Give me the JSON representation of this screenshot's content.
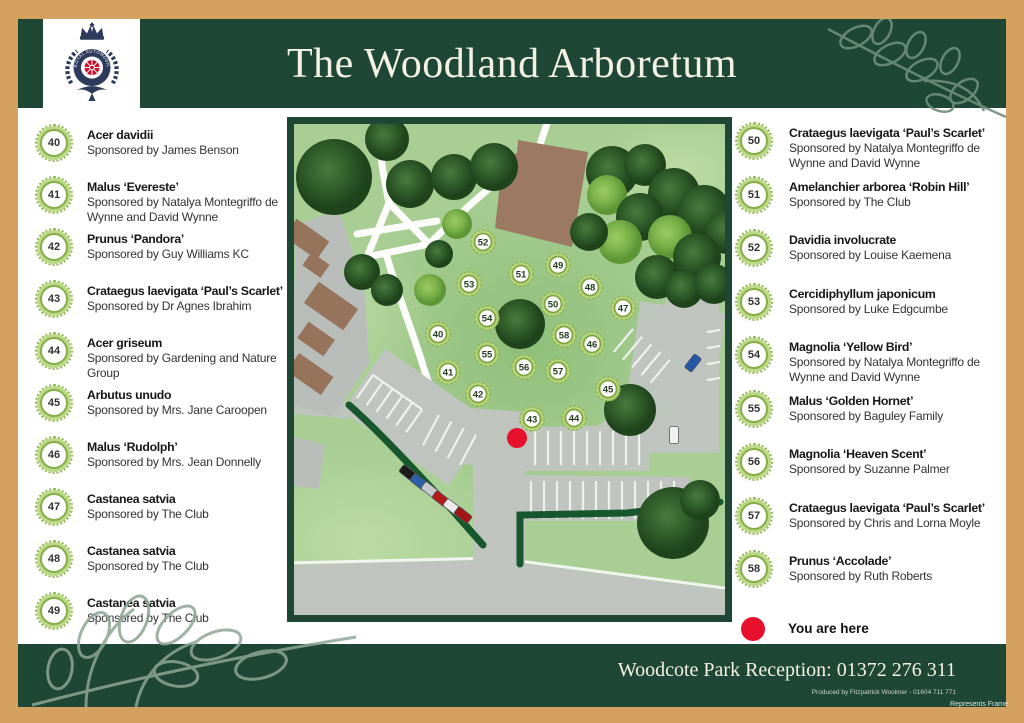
{
  "colors": {
    "frame_tan": "#D5A161",
    "band_green": "#1E4736",
    "marker_green": "#86AD48",
    "you_are_here_red": "#E8112D"
  },
  "header": {
    "title": "The Woodland Arboretum",
    "logo_text": "ROYAL AUTOMOBILE CLUB"
  },
  "left_list": [
    {
      "num": "40",
      "name": "Acer davidii",
      "sponsor": "Sponsored by James Benson"
    },
    {
      "num": "41",
      "name": "Malus ‘Evereste’",
      "sponsor": "Sponsored by Natalya Montegriffo de Wynne and David Wynne"
    },
    {
      "num": "42",
      "name": "Prunus ‘Pandora’",
      "sponsor": "Sponsored by Guy Williams KC"
    },
    {
      "num": "43",
      "name": "Crataegus laevigata ‘Paul’s Scarlet’",
      "sponsor": "Sponsored by Dr Agnes Ibrahim"
    },
    {
      "num": "44",
      "name": "Acer griseum",
      "sponsor": "Sponsored by Gardening and Nature Group"
    },
    {
      "num": "45",
      "name": "Arbutus unudo",
      "sponsor": "Sponsored by Mrs. Jane Caroopen"
    },
    {
      "num": "46",
      "name": "Malus ‘Rudolph’",
      "sponsor": "Sponsored by Mrs. Jean Donnelly"
    },
    {
      "num": "47",
      "name": "Castanea satvia",
      "sponsor": "Sponsored by The Club"
    },
    {
      "num": "48",
      "name": "Castanea satvia",
      "sponsor": "Sponsored by The Club"
    },
    {
      "num": "49",
      "name": "Castanea satvia",
      "sponsor": "Sponsored by The Club"
    }
  ],
  "right_list": [
    {
      "num": "50",
      "name": "Crataegus laevigata ‘Paul’s Scarlet’",
      "sponsor": "Sponsored by Natalya Montegriffo de Wynne and David Wynne"
    },
    {
      "num": "51",
      "name": "Amelanchier arborea ‘Robin Hill’",
      "sponsor": "Sponsored by The Club"
    },
    {
      "num": "52",
      "name": "Davidia involucrate",
      "sponsor": "Sponsored by Louise Kaemena"
    },
    {
      "num": "53",
      "name": "Cercidiphyllum japonicum",
      "sponsor": "Sponsored by Luke Edgcumbe"
    },
    {
      "num": "54",
      "name": "Magnolia ‘Yellow Bird’",
      "sponsor": "Sponsored by Natalya Montegriffo de Wynne and David Wynne"
    },
    {
      "num": "55",
      "name": "Malus ‘Golden Hornet’",
      "sponsor": "Sponsored by Baguley Family"
    },
    {
      "num": "56",
      "name": "Magnolia ‘Heaven Scent’",
      "sponsor": "Sponsored by Suzanne Palmer"
    },
    {
      "num": "57",
      "name": "Crataegus laevigata ‘Paul’s Scarlet’",
      "sponsor": "Sponsored by Chris and Lorna Moyle"
    },
    {
      "num": "58",
      "name": "Prunus ‘Accolade’",
      "sponsor": "Sponsored by Ruth Roberts"
    }
  ],
  "legend": {
    "you_are_here": "You are here"
  },
  "map": {
    "markers": [
      {
        "n": "40",
        "x": 151,
        "y": 217
      },
      {
        "n": "41",
        "x": 161,
        "y": 255
      },
      {
        "n": "42",
        "x": 191,
        "y": 277
      },
      {
        "n": "43",
        "x": 245,
        "y": 302
      },
      {
        "n": "44",
        "x": 287,
        "y": 301
      },
      {
        "n": "45",
        "x": 321,
        "y": 272
      },
      {
        "n": "46",
        "x": 305,
        "y": 227
      },
      {
        "n": "47",
        "x": 336,
        "y": 191
      },
      {
        "n": "48",
        "x": 303,
        "y": 170
      },
      {
        "n": "49",
        "x": 271,
        "y": 148
      },
      {
        "n": "50",
        "x": 266,
        "y": 187
      },
      {
        "n": "51",
        "x": 234,
        "y": 157
      },
      {
        "n": "52",
        "x": 196,
        "y": 125
      },
      {
        "n": "53",
        "x": 182,
        "y": 167
      },
      {
        "n": "54",
        "x": 200,
        "y": 201
      },
      {
        "n": "55",
        "x": 200,
        "y": 237
      },
      {
        "n": "56",
        "x": 237,
        "y": 250
      },
      {
        "n": "57",
        "x": 271,
        "y": 254
      },
      {
        "n": "58",
        "x": 277,
        "y": 218
      }
    ],
    "you_are_here": {
      "x": 230,
      "y": 321
    }
  },
  "footer": {
    "reception": "Woodcote Park Reception: 01372 276 311",
    "produced_by": "Produced by Fitzpatrick Woolmer - 01604 711 771",
    "frame_note": "Represents Frame"
  }
}
